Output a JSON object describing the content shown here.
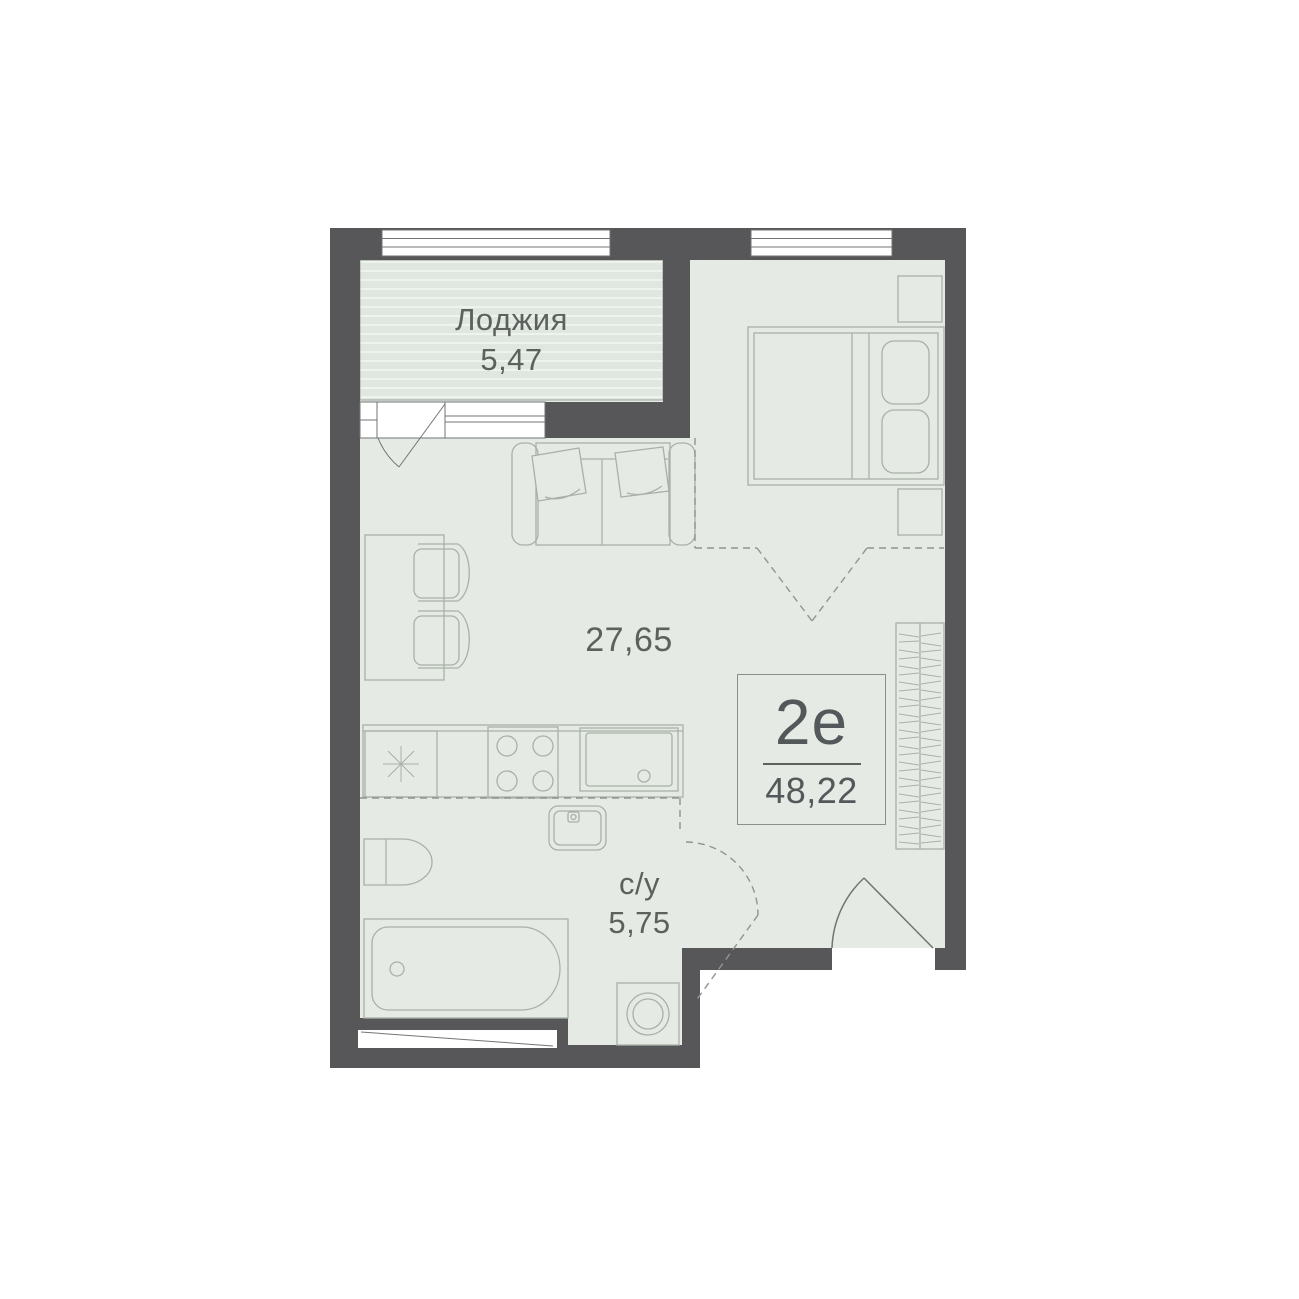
{
  "plan": {
    "unit": {
      "type": "2е",
      "total_area": "48,22"
    },
    "rooms": {
      "loggia": {
        "label": "Лоджия",
        "area": "5,47"
      },
      "living": {
        "area": "27,65"
      },
      "bathroom": {
        "label": "с/у",
        "area": "5,75"
      }
    },
    "legend": {
      "fridge_icon": "snowflake-asterisk",
      "stove_icon": "four-burners",
      "wardrobe_icon": "hanger-hatching"
    },
    "colors": {
      "wall": "#57575A",
      "floor": "#E5EAE4",
      "loggia_fill": "#E0E7E0",
      "loggia_stripe": "#EFF3EE",
      "furniture_stroke": "#A8B1A8",
      "door_stroke": "#707573",
      "dashed_stroke": "#8F968F",
      "text": "#5C615E",
      "window_white": "#FFFFFF"
    }
  }
}
